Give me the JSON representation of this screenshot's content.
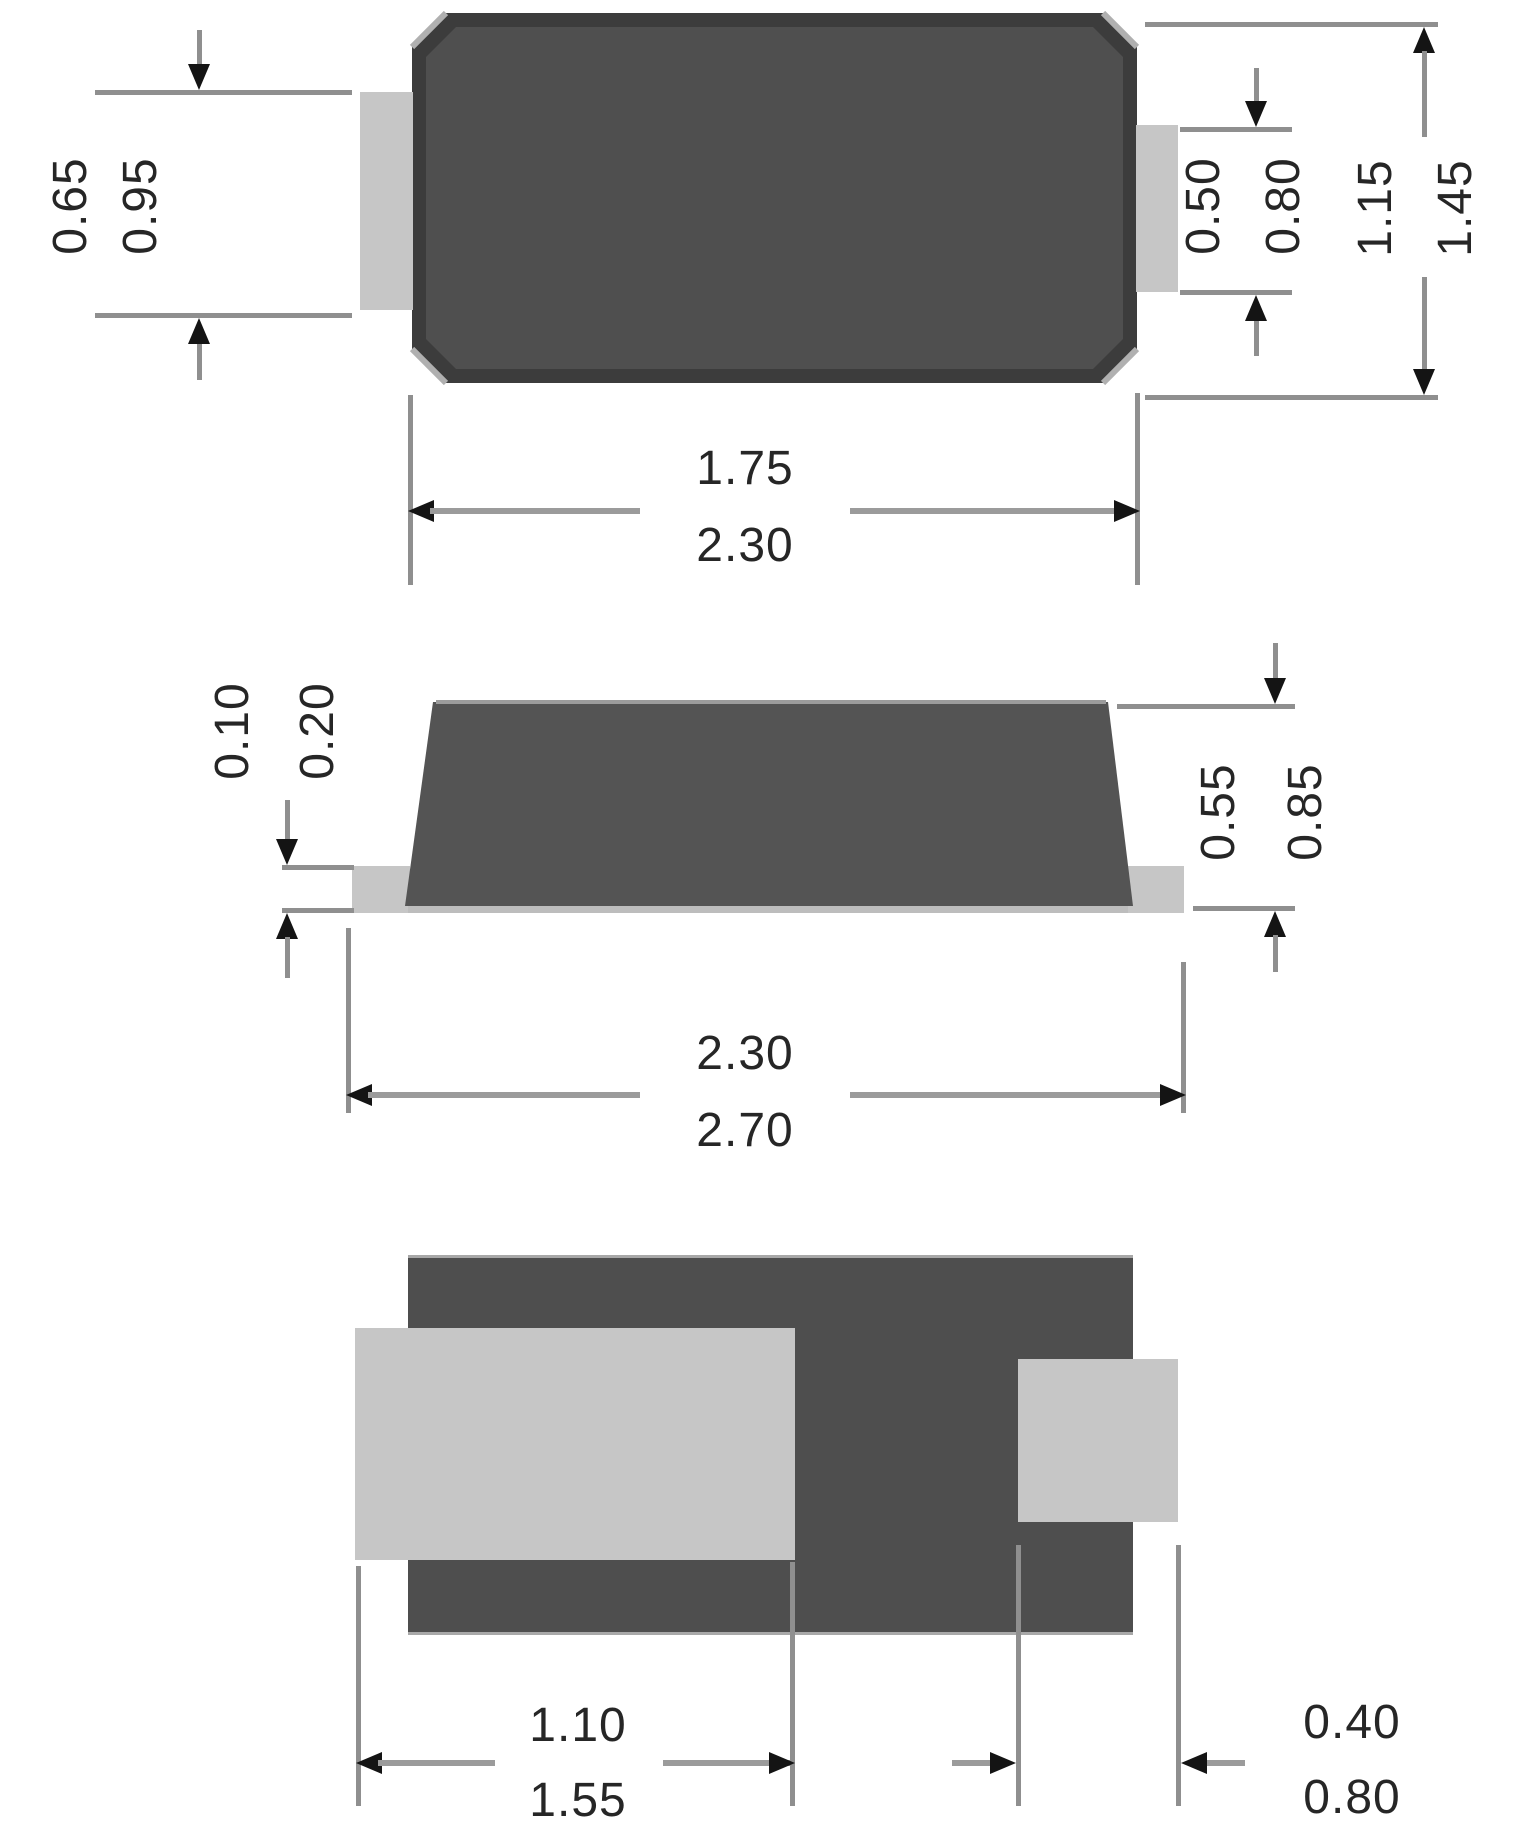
{
  "drawing": {
    "type": "smd-package-outline-drawing",
    "views": {
      "top": {
        "name": "top-view",
        "tab_left_dim": {
          "min": "0.65",
          "max": "0.95"
        },
        "tab_right_dim": {
          "min": "0.50",
          "max": "0.80"
        },
        "body_width_dim": {
          "min": "1.15",
          "max": "1.45"
        },
        "body_length_dim": {
          "min": "1.75",
          "max": "2.30"
        }
      },
      "side": {
        "name": "side-view",
        "lead_thickness_dim": {
          "min": "0.10",
          "max": "0.20"
        },
        "body_height_dim": {
          "min": "0.55",
          "max": "0.85"
        },
        "overall_length_dim": {
          "min": "2.30",
          "max": "2.70"
        }
      },
      "bottom": {
        "name": "bottom-view",
        "left_pad_dim": {
          "min": "1.10",
          "max": "1.55"
        },
        "right_pad_dim": {
          "min": "0.40",
          "max": "0.80"
        }
      }
    },
    "colors": {
      "body_fill": "#4f4f4f",
      "body_edge": "#3c3c3c",
      "terminal_fill": "#c6c6c6",
      "base_strip": "#bdbdbd",
      "dim_line": "#8f8f8f",
      "arrow": "#141414",
      "text": "#262626",
      "background": "#ffffff"
    }
  }
}
